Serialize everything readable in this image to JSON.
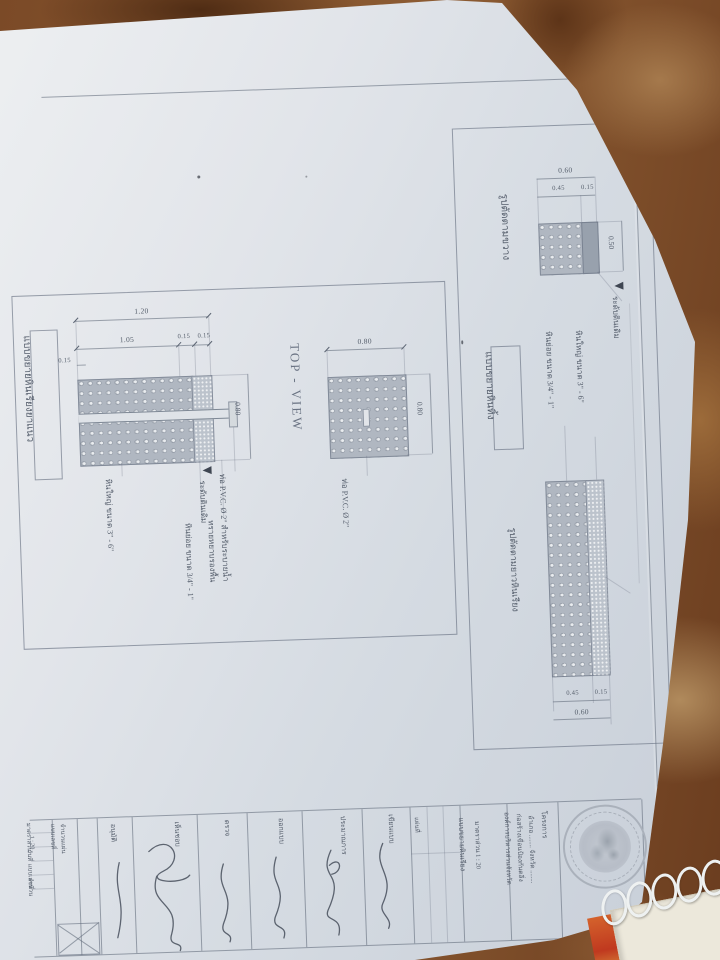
{
  "left_panel": {
    "title": "แบบขยายหินเรียงยาแนว",
    "dims": {
      "total": "1.20",
      "main": "1.05",
      "seg_a": "0.15",
      "seg_b": "0.15",
      "edge": "0.15",
      "height": "0.80"
    },
    "annotations": [
      "หินใหญ่ ขนาด 3\" - 6\"",
      "หินย่อย ขนาด 3/4\" - 1\"",
      "ระดับดินเดิม",
      "ทรายหยาบรองพื้น",
      "ท่อ P.V.C. Ø 2\" สำหรับระบายน้ำ"
    ],
    "top_view": {
      "label": "TOP - VIEW",
      "width": "0.80",
      "height": "0.80",
      "note": "ท่อ P.V.C. Ø 2\""
    }
  },
  "right_panel": {
    "section_label": "รูปตัดตามขวาง",
    "detail_label": "แบบขยายหินทิ้ง",
    "long_label": "รูปตัดตามยาวหินเรียง",
    "dims": {
      "total": "0.60",
      "main": "0.45",
      "seg": "0.15",
      "height": "0.50"
    },
    "bar_dims": {
      "main": "0.45",
      "seg": "0.15",
      "total": "0.60"
    },
    "notes": [
      "หินย่อย ขนาด 3/4\" - 1\"",
      "หินใหญ่ ขนาด 3\" - 6\"",
      "ระดับดินเดิม"
    ]
  },
  "title_block": {
    "headers": [
      "อนุมัติ",
      "เห็นชอบ",
      "ตรวจ",
      "ออกแบบ",
      "ประมาณการ",
      "เขียนแบบ"
    ],
    "sheet_label": "แผ่นที่",
    "drawing_title": "แบบขยายหินเรียง",
    "scale": "มาตราส่วน 1 : 20",
    "project_label": "โครงการ",
    "org_lines": [
      "องค์การบริหารส่วนจังหวัด",
      "ก่อสร้างเขื่อนป้องกันตลิ่ง",
      "อำเภอ ........ จังหวัด ........"
    ],
    "mini_rows": [
      "มาตราส่วน",
      "1 : 20",
      "วันที่",
      "แบบเลขที่",
      "จำนวน"
    ],
    "mini_rows2": [
      "แบบเลขที่",
      "จำนวนแผ่น"
    ]
  }
}
